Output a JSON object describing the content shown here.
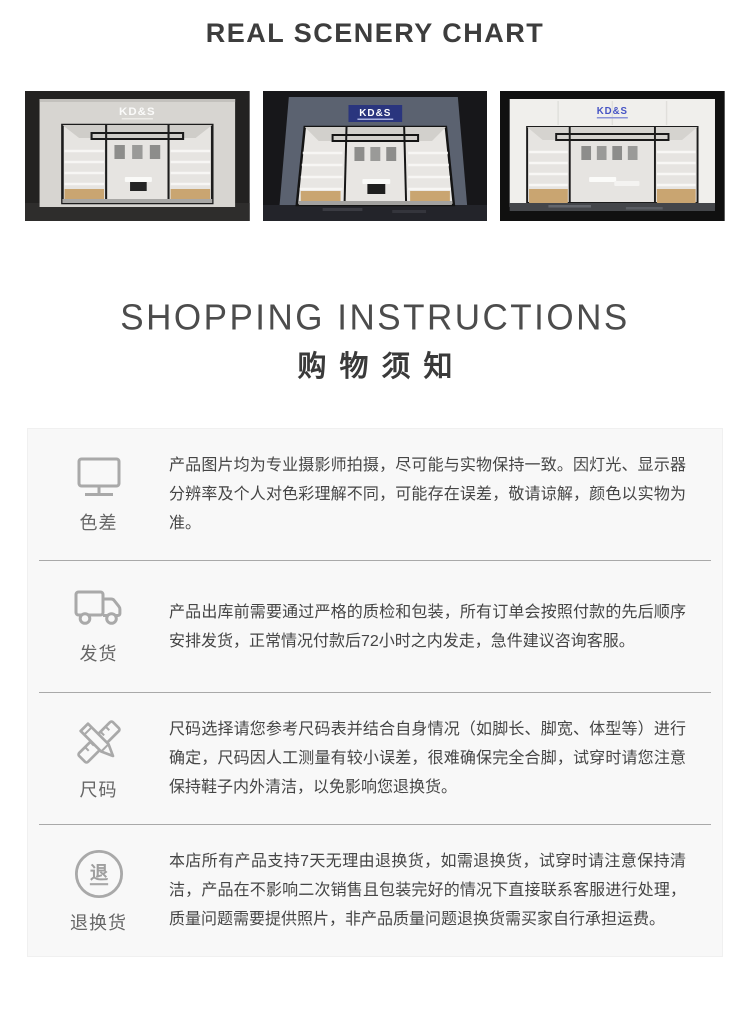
{
  "header": {
    "title": "REAL SCENERY CHART"
  },
  "gallery": {
    "images": [
      {
        "name": "storefront-render-gray-facade",
        "sign": "KD&S"
      },
      {
        "name": "storefront-render-dark-facade",
        "sign": "KD&S"
      },
      {
        "name": "storefront-render-white-facade",
        "sign": "KD&S"
      }
    ]
  },
  "instructions": {
    "title_en": "SHOPPING INSTRUCTIONS",
    "title_zh": "购物须知",
    "return_icon_char": "退",
    "items": [
      {
        "icon": "monitor-icon",
        "label": "色差",
        "text": "产品图片均为专业摄影师拍摄，尽可能与实物保持一致。因灯光、显示器分辨率及个人对色彩理解不同，可能存在误差，敬请谅解，颜色以实物为准。"
      },
      {
        "icon": "truck-icon",
        "label": "发货",
        "text": "产品出库前需要通过严格的质检和包装，所有订单会按照付款的先后顺序安排发货，正常情况付款后72小时之内发走，急件建议咨询客服。"
      },
      {
        "icon": "pencil-ruler-icon",
        "label": "尺码",
        "text": "尺码选择请您参考尺码表并结合自身情况（如脚长、脚宽、体型等）进行确定，尺码因人工测量有较小误差，很难确保完全合脚，试穿时请您注意保持鞋子内外清洁，以免影响您退换货。"
      },
      {
        "icon": "return-icon",
        "label": "退换货",
        "text": "本店所有产品支持7天无理由退换货，如需退换货，试穿时请注意保持清洁，产品在不影响二次销售且包装完好的情况下直接联系客服进行处理，质量问题需要提供照片，非产品质量问题退换货需买家自行承担运费。"
      }
    ]
  },
  "colors": {
    "icon_gray": "#a9a9a9",
    "divider_gray": "#a9a9a9",
    "panel_bg": "#f8f8f8",
    "sign_navy": "#2a357e",
    "sign_blue": "#4553c4"
  }
}
